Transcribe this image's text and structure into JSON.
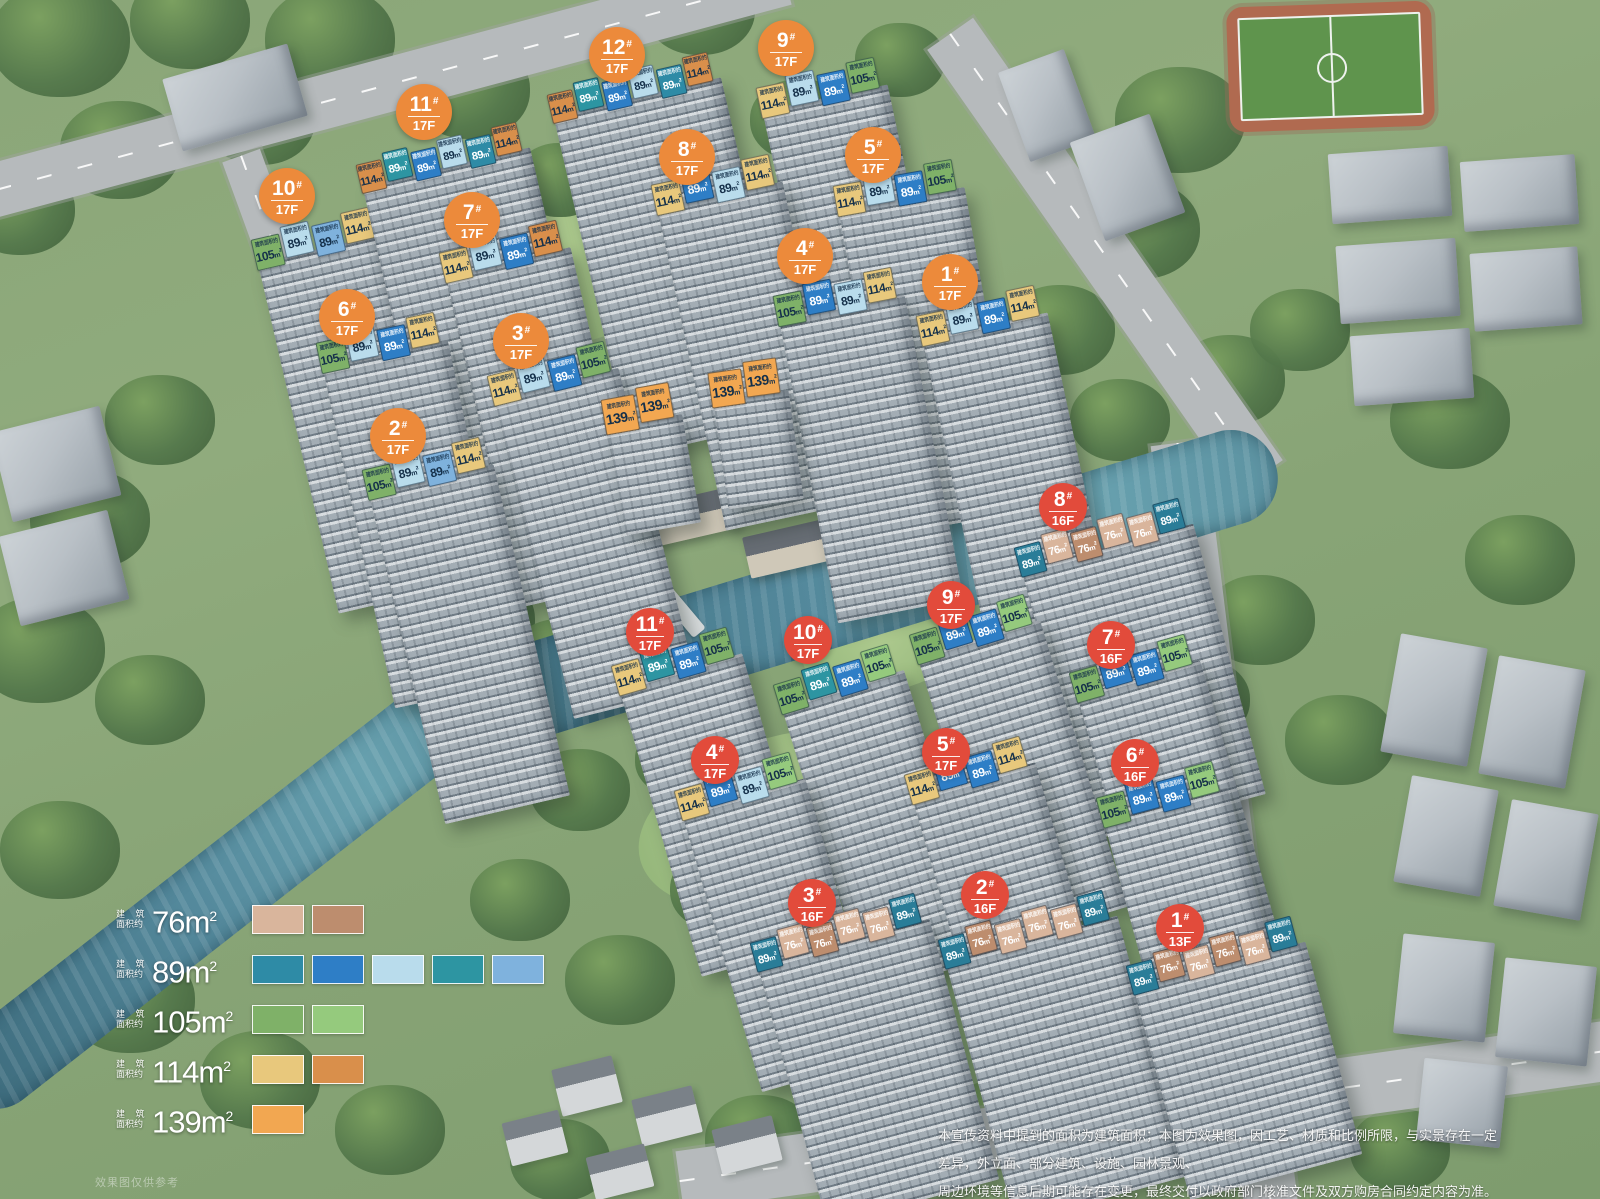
{
  "labels": {
    "roof_caption": "建筑面积约",
    "unit_base": "m",
    "unit_sup": "2",
    "legend_caption_top": "建 筑",
    "legend_caption_bottom": "面积约",
    "watermark": "效果图仅供参考"
  },
  "badge_colors": {
    "north": "#ec8a3b",
    "south": "#e24b3b"
  },
  "badge_sizes": {
    "north": 56,
    "south": 48
  },
  "area_variants": {
    "76L": {
      "fill": "#d9b59c",
      "text": "#ffffff"
    },
    "76D": {
      "fill": "#bd8d6e",
      "text": "#ffffff"
    },
    "89S": {
      "fill": "#2e8ba6",
      "text": "#ffffff"
    },
    "89B": {
      "fill": "#2e7ec6",
      "text": "#ffffff"
    },
    "89P": {
      "fill": "#b9dcec",
      "text": "#15304a"
    },
    "89T": {
      "fill": "#2d95a2",
      "text": "#ffffff"
    },
    "89M": {
      "fill": "#7fb2dd",
      "text": "#15304a"
    },
    "89DP": {
      "fill": "#2a7d98",
      "text": "#ffffff"
    },
    "105": {
      "fill": "#7fb168",
      "text": "#15304a"
    },
    "105L": {
      "fill": "#95ca7d",
      "text": "#15304a"
    },
    "114S": {
      "fill": "#e8c87c",
      "text": "#15304a"
    },
    "114O": {
      "fill": "#d98f4b",
      "text": "#15304a"
    },
    "139": {
      "fill": "#f2a751",
      "text": "#15304a"
    }
  },
  "legend": [
    {
      "area": "76",
      "swatches": [
        "#d9b59c",
        "#bd8d6e"
      ]
    },
    {
      "area": "89",
      "swatches": [
        "#2e8ba6",
        "#2e7ec6",
        "#b9dcec",
        "#2d95a2",
        "#7fb2dd"
      ]
    },
    {
      "area": "105",
      "swatches": [
        "#7fb168",
        "#95ca7d"
      ]
    },
    {
      "area": "114",
      "swatches": [
        "#e8c87c",
        "#d98f4b"
      ]
    },
    {
      "area": "139",
      "swatches": [
        "#f2a751"
      ]
    }
  ],
  "buildings": [
    {
      "id": "10",
      "floors": "17F",
      "parcel": "north",
      "tower_h": 360,
      "tw": 29,
      "th": 32,
      "fs": 12,
      "badge": {
        "x": 287,
        "y": 196
      },
      "roof": {
        "x": 250,
        "y": 238,
        "angle": -13,
        "tiles": [
          {
            "a": "105",
            "v": "105"
          },
          {
            "a": "89",
            "v": "89P"
          },
          {
            "a": "89",
            "v": "89M"
          },
          {
            "a": "114",
            "v": "114S"
          }
        ]
      }
    },
    {
      "id": "11",
      "floors": "17F",
      "parcel": "north",
      "tower_h": 350,
      "tw": 26,
      "th": 30,
      "fs": 11,
      "badge": {
        "x": 424,
        "y": 112
      },
      "roof": {
        "x": 355,
        "y": 163,
        "angle": -13,
        "tiles": [
          {
            "a": "114",
            "v": "114O"
          },
          {
            "a": "89",
            "v": "89T"
          },
          {
            "a": "89",
            "v": "89B"
          },
          {
            "a": "89",
            "v": "89P"
          },
          {
            "a": "89",
            "v": "89S"
          },
          {
            "a": "114",
            "v": "114O"
          }
        ]
      }
    },
    {
      "id": "12",
      "floors": "17F",
      "parcel": "north",
      "tower_h": 350,
      "tw": 26,
      "th": 30,
      "fs": 11,
      "badge": {
        "x": 617,
        "y": 55
      },
      "roof": {
        "x": 546,
        "y": 93,
        "angle": -13,
        "tiles": [
          {
            "a": "114",
            "v": "114O"
          },
          {
            "a": "89",
            "v": "89T"
          },
          {
            "a": "89",
            "v": "89B"
          },
          {
            "a": "89",
            "v": "89P"
          },
          {
            "a": "89",
            "v": "89S"
          },
          {
            "a": "114",
            "v": "114O"
          }
        ]
      }
    },
    {
      "id": "9",
      "floors": "17F",
      "parcel": "north",
      "tower_h": 340,
      "tw": 29,
      "th": 32,
      "fs": 12,
      "badge": {
        "x": 786,
        "y": 48
      },
      "roof": {
        "x": 755,
        "y": 86,
        "angle": -12,
        "tiles": [
          {
            "a": "114",
            "v": "114S"
          },
          {
            "a": "89",
            "v": "89P"
          },
          {
            "a": "89",
            "v": "89B"
          },
          {
            "a": "105",
            "v": "105"
          }
        ]
      }
    },
    {
      "id": "8",
      "floors": "17F",
      "parcel": "north",
      "tower_h": 330,
      "tw": 29,
      "th": 32,
      "fs": 12,
      "badge": {
        "x": 687,
        "y": 157
      },
      "roof": {
        "x": 650,
        "y": 183,
        "angle": -12,
        "tiles": [
          {
            "a": "114",
            "v": "114S"
          },
          {
            "a": "89",
            "v": "89B"
          },
          {
            "a": "89",
            "v": "89P"
          },
          {
            "a": "114",
            "v": "114S"
          }
        ]
      }
    },
    {
      "id": "5",
      "floors": "17F",
      "parcel": "north",
      "tower_h": 330,
      "tw": 29,
      "th": 32,
      "fs": 12,
      "badge": {
        "x": 873,
        "y": 155
      },
      "roof": {
        "x": 832,
        "y": 184,
        "angle": -10,
        "tiles": [
          {
            "a": "114",
            "v": "114S"
          },
          {
            "a": "89",
            "v": "89P"
          },
          {
            "a": "89",
            "v": "89B"
          },
          {
            "a": "105",
            "v": "105"
          }
        ]
      }
    },
    {
      "id": "7",
      "floors": "17F",
      "parcel": "north",
      "tower_h": 340,
      "tw": 29,
      "th": 32,
      "fs": 12,
      "badge": {
        "x": 472,
        "y": 220
      },
      "roof": {
        "x": 438,
        "y": 251,
        "angle": -13,
        "tiles": [
          {
            "a": "114",
            "v": "114S"
          },
          {
            "a": "89",
            "v": "89P"
          },
          {
            "a": "89",
            "v": "89B"
          },
          {
            "a": "114",
            "v": "114O"
          }
        ]
      }
    },
    {
      "id": "6",
      "floors": "17F",
      "parcel": "north",
      "tower_h": 350,
      "tw": 29,
      "th": 32,
      "fs": 12,
      "badge": {
        "x": 347,
        "y": 317
      },
      "roof": {
        "x": 315,
        "y": 341,
        "angle": -12,
        "tiles": [
          {
            "a": "105",
            "v": "105"
          },
          {
            "a": "89",
            "v": "89P"
          },
          {
            "a": "89",
            "v": "89B"
          },
          {
            "a": "114",
            "v": "114S"
          }
        ]
      }
    },
    {
      "id": "3",
      "floors": "17F",
      "parcel": "north",
      "tower_h": 330,
      "tw": 29,
      "th": 32,
      "fs": 12,
      "badge": {
        "x": 521,
        "y": 341
      },
      "roof": {
        "x": 486,
        "y": 374,
        "angle": -14,
        "tiles": [
          {
            "a": "114",
            "v": "114S"
          },
          {
            "a": "89",
            "v": "89P"
          },
          {
            "a": "89",
            "v": "89B"
          },
          {
            "a": "105",
            "v": "105"
          }
        ]
      }
    },
    {
      "id": "2",
      "floors": "17F",
      "parcel": "north",
      "tower_h": 340,
      "tw": 29,
      "th": 32,
      "fs": 12,
      "badge": {
        "x": 398,
        "y": 436
      },
      "roof": {
        "x": 361,
        "y": 468,
        "angle": -13,
        "tiles": [
          {
            "a": "105",
            "v": "105"
          },
          {
            "a": "89",
            "v": "89P"
          },
          {
            "a": "89",
            "v": "89M"
          },
          {
            "a": "114",
            "v": "114S"
          }
        ]
      }
    },
    {
      "id": "4",
      "floors": "17F",
      "parcel": "north",
      "tower_h": 310,
      "tw": 29,
      "th": 32,
      "fs": 12,
      "badge": {
        "x": 805,
        "y": 256
      },
      "roof": {
        "x": 772,
        "y": 294,
        "angle": -11,
        "tiles": [
          {
            "a": "105",
            "v": "105"
          },
          {
            "a": "89",
            "v": "89B"
          },
          {
            "a": "89",
            "v": "89P"
          },
          {
            "a": "114",
            "v": "114S"
          }
        ]
      }
    },
    {
      "id": "1",
      "floors": "17F",
      "parcel": "north",
      "tower_h": 300,
      "tw": 29,
      "th": 32,
      "fs": 12,
      "badge": {
        "x": 950,
        "y": 282
      },
      "roof": {
        "x": 915,
        "y": 314,
        "angle": -12,
        "tiles": [
          {
            "a": "114",
            "v": "114S"
          },
          {
            "a": "89",
            "v": "89P"
          },
          {
            "a": "89",
            "v": "89B"
          },
          {
            "a": "114",
            "v": "114S"
          }
        ]
      }
    },
    {
      "id": null,
      "floors": null,
      "parcel": "north",
      "tower_h": 110,
      "tw": 34,
      "th": 36,
      "fs": 14,
      "badge": null,
      "roof": {
        "x": 600,
        "y": 398,
        "angle": -10,
        "tiles": [
          {
            "a": "139",
            "v": "139"
          },
          {
            "a": "139",
            "v": "139"
          }
        ]
      }
    },
    {
      "id": null,
      "floors": null,
      "parcel": "north",
      "tower_h": 110,
      "tw": 34,
      "th": 36,
      "fs": 14,
      "badge": null,
      "roof": {
        "x": 707,
        "y": 371,
        "angle": -8,
        "tiles": [
          {
            "a": "139",
            "v": "139"
          },
          {
            "a": "139",
            "v": "139"
          }
        ]
      }
    },
    {
      "id": "8",
      "floors": "16F",
      "parcel": "south",
      "tower_h": 280,
      "tw": 27,
      "th": 31,
      "fs": 11,
      "badge": {
        "x": 1063,
        "y": 507
      },
      "roof": {
        "x": 1013,
        "y": 546,
        "angle": -15,
        "tiles": [
          {
            "a": "89",
            "v": "89DP"
          },
          {
            "a": "76",
            "v": "76L"
          },
          {
            "a": "76",
            "v": "76D"
          },
          {
            "a": "76",
            "v": "76L"
          },
          {
            "a": "76",
            "v": "76L"
          },
          {
            "a": "89",
            "v": "89DP"
          }
        ]
      }
    },
    {
      "id": "9",
      "floors": "17F",
      "parcel": "south",
      "tower_h": 300,
      "tw": 29,
      "th": 32,
      "fs": 12,
      "badge": {
        "x": 951,
        "y": 605
      },
      "roof": {
        "x": 908,
        "y": 633,
        "angle": -17,
        "tiles": [
          {
            "a": "105",
            "v": "105"
          },
          {
            "a": "89",
            "v": "89B"
          },
          {
            "a": "89",
            "v": "89B"
          },
          {
            "a": "105",
            "v": "105L"
          }
        ]
      }
    },
    {
      "id": "7",
      "floors": "16F",
      "parcel": "south",
      "tower_h": 290,
      "tw": 29,
      "th": 32,
      "fs": 12,
      "badge": {
        "x": 1111,
        "y": 645
      },
      "roof": {
        "x": 1068,
        "y": 671,
        "angle": -16,
        "tiles": [
          {
            "a": "105",
            "v": "105"
          },
          {
            "a": "89",
            "v": "89B"
          },
          {
            "a": "89",
            "v": "89B"
          },
          {
            "a": "105",
            "v": "105L"
          }
        ]
      }
    },
    {
      "id": "11",
      "floors": "17F",
      "parcel": "south",
      "tower_h": 300,
      "tw": 29,
      "th": 32,
      "fs": 12,
      "badge": {
        "x": 650,
        "y": 632
      },
      "roof": {
        "x": 610,
        "y": 664,
        "angle": -16,
        "tiles": [
          {
            "a": "114",
            "v": "114S"
          },
          {
            "a": "89",
            "v": "89T"
          },
          {
            "a": "89",
            "v": "89B"
          },
          {
            "a": "105",
            "v": "105"
          }
        ]
      }
    },
    {
      "id": "10",
      "floors": "17F",
      "parcel": "south",
      "tower_h": 300,
      "tw": 29,
      "th": 32,
      "fs": 12,
      "badge": {
        "x": 808,
        "y": 640
      },
      "roof": {
        "x": 772,
        "y": 683,
        "angle": -17,
        "tiles": [
          {
            "a": "105",
            "v": "105"
          },
          {
            "a": "89",
            "v": "89T"
          },
          {
            "a": "89",
            "v": "89B"
          },
          {
            "a": "105",
            "v": "105L"
          }
        ]
      }
    },
    {
      "id": "4",
      "floors": "17F",
      "parcel": "south",
      "tower_h": 290,
      "tw": 29,
      "th": 32,
      "fs": 12,
      "badge": {
        "x": 715,
        "y": 760
      },
      "roof": {
        "x": 673,
        "y": 789,
        "angle": -16,
        "tiles": [
          {
            "a": "114",
            "v": "114S"
          },
          {
            "a": "89",
            "v": "89B"
          },
          {
            "a": "89",
            "v": "89P"
          },
          {
            "a": "105",
            "v": "105L"
          }
        ]
      }
    },
    {
      "id": "5",
      "floors": "17F",
      "parcel": "south",
      "tower_h": 280,
      "tw": 29,
      "th": 32,
      "fs": 12,
      "badge": {
        "x": 946,
        "y": 752
      },
      "roof": {
        "x": 903,
        "y": 773,
        "angle": -16,
        "tiles": [
          {
            "a": "114",
            "v": "114S"
          },
          {
            "a": "89",
            "v": "89B"
          },
          {
            "a": "89",
            "v": "89B"
          },
          {
            "a": "114",
            "v": "114S"
          }
        ]
      }
    },
    {
      "id": "6",
      "floors": "16F",
      "parcel": "south",
      "tower_h": 270,
      "tw": 29,
      "th": 32,
      "fs": 12,
      "badge": {
        "x": 1135,
        "y": 763
      },
      "roof": {
        "x": 1095,
        "y": 796,
        "angle": -15,
        "tiles": [
          {
            "a": "105",
            "v": "105"
          },
          {
            "a": "89",
            "v": "89B"
          },
          {
            "a": "89",
            "v": "89B"
          },
          {
            "a": "105",
            "v": "105L"
          }
        ]
      }
    },
    {
      "id": "3",
      "floors": "16F",
      "parcel": "south",
      "tower_h": 270,
      "tw": 27,
      "th": 31,
      "fs": 11,
      "badge": {
        "x": 812,
        "y": 903
      },
      "roof": {
        "x": 749,
        "y": 941,
        "angle": -15,
        "tiles": [
          {
            "a": "89",
            "v": "89DP"
          },
          {
            "a": "76",
            "v": "76L"
          },
          {
            "a": "76",
            "v": "76D"
          },
          {
            "a": "76",
            "v": "76L"
          },
          {
            "a": "76",
            "v": "76L"
          },
          {
            "a": "89",
            "v": "89DP"
          }
        ]
      }
    },
    {
      "id": "2",
      "floors": "16F",
      "parcel": "south",
      "tower_h": 270,
      "tw": 27,
      "th": 31,
      "fs": 11,
      "badge": {
        "x": 985,
        "y": 895
      },
      "roof": {
        "x": 937,
        "y": 938,
        "angle": -15,
        "tiles": [
          {
            "a": "89",
            "v": "89DP"
          },
          {
            "a": "76",
            "v": "76D"
          },
          {
            "a": "76",
            "v": "76L"
          },
          {
            "a": "76",
            "v": "76L"
          },
          {
            "a": "76",
            "v": "76L"
          },
          {
            "a": "89",
            "v": "89DP"
          }
        ]
      }
    },
    {
      "id": "1",
      "floors": "13F",
      "parcel": "south",
      "tower_h": 220,
      "tw": 27,
      "th": 31,
      "fs": 11,
      "badge": {
        "x": 1180,
        "y": 928
      },
      "roof": {
        "x": 1125,
        "y": 964,
        "angle": -15,
        "tiles": [
          {
            "a": "89",
            "v": "89DP"
          },
          {
            "a": "76",
            "v": "76D"
          },
          {
            "a": "76",
            "v": "76L"
          },
          {
            "a": "76",
            "v": "76D"
          },
          {
            "a": "76",
            "v": "76L"
          },
          {
            "a": "89",
            "v": "89DP"
          }
        ]
      }
    }
  ],
  "disclaimer": {
    "line1": "本宣传资料中提到的面积为建筑面积；本图为效果图，因工艺、材质和比例所限，与实景存在一定差异，外立面、部分建筑、设施、园林景观、",
    "line2": "周边环境等信息后期可能存在变更，最终交付以政府部门核准文件及双方购房合同约定内容为准。一切未列举事项或更改，不再另行通知。"
  }
}
